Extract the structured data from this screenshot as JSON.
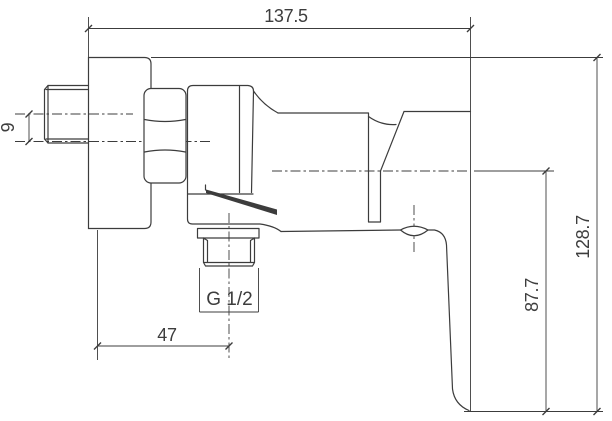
{
  "drawing": {
    "title": "shower-mixer-technical-drawing",
    "background_color": "#ffffff",
    "line_color": "#3c3c3c",
    "text_color": "#3d3d3d",
    "dimensions": {
      "overall_length": "137.5",
      "inlet_centerline_offset": "9",
      "outlet_center_distance": "47",
      "handle_drop_below_centerline": "87.7",
      "overall_height": "128.7",
      "outlet_thread_size": "G 1/2"
    }
  }
}
